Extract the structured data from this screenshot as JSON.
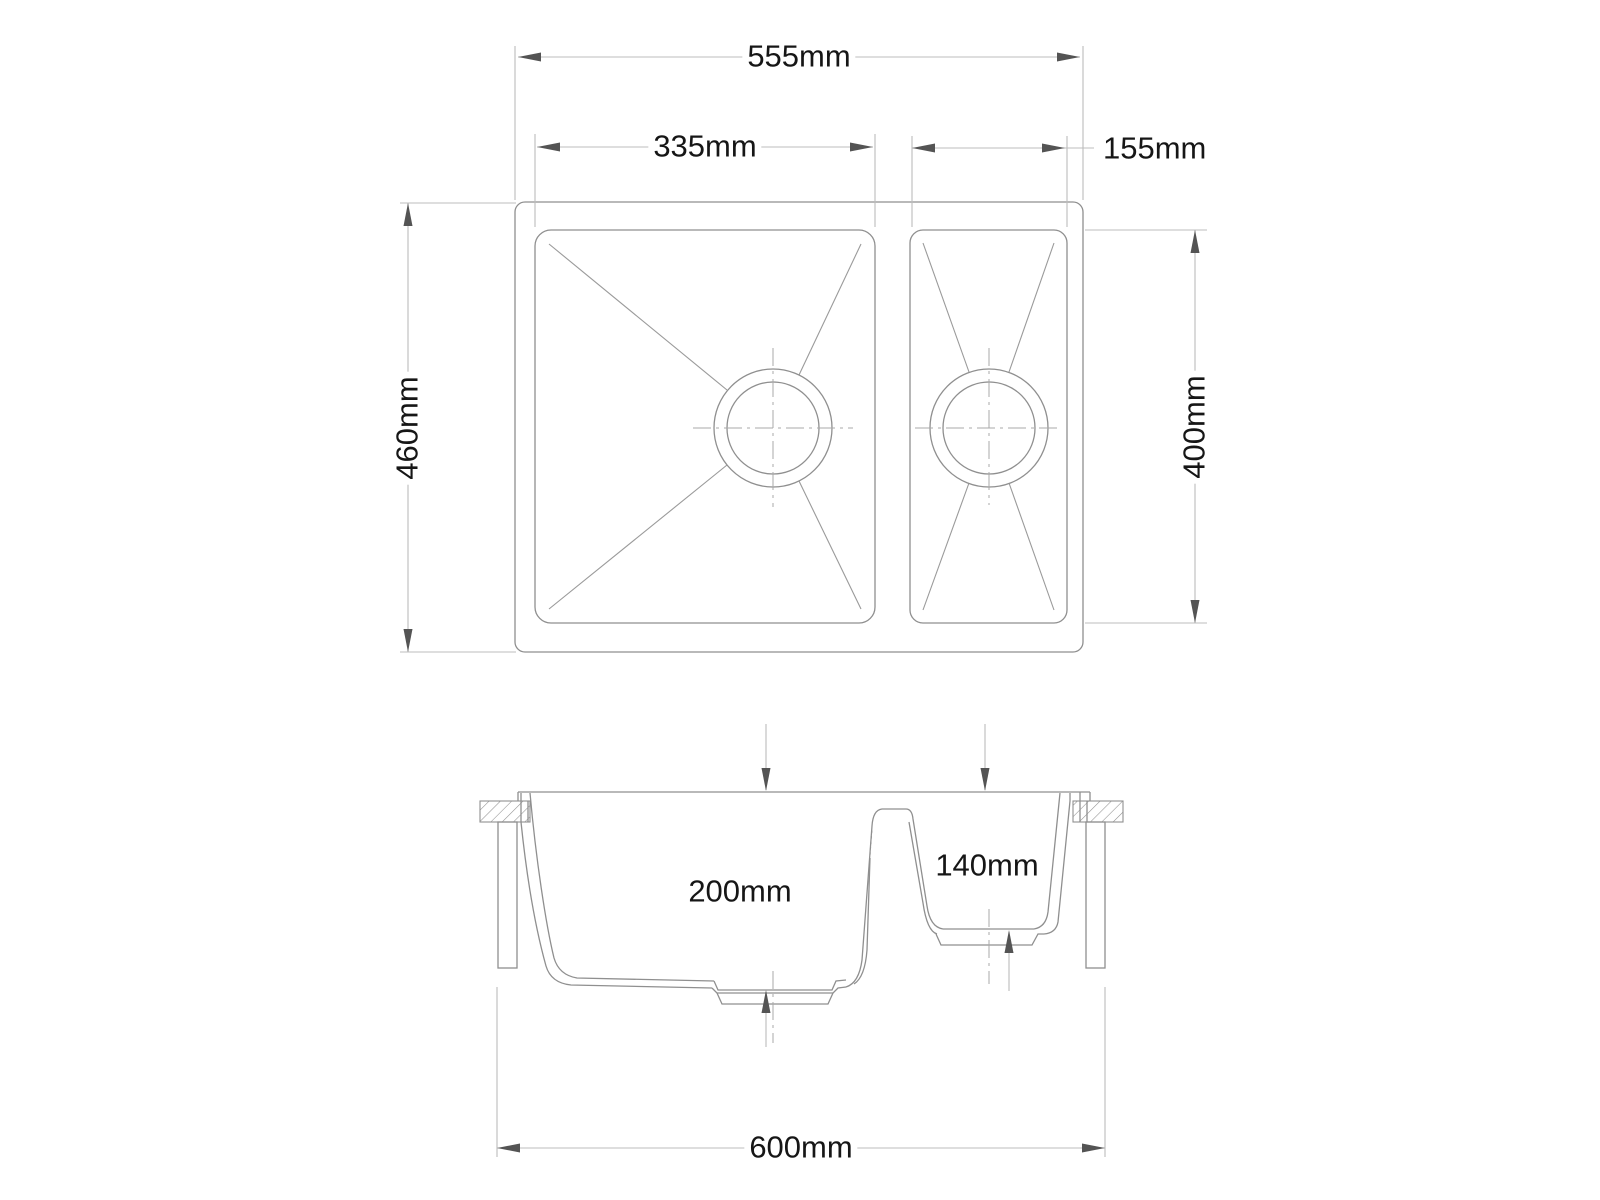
{
  "drawing": {
    "type": "technical-drawing",
    "subject": "one-and-a-half bowl undermount kitchen sink, plan and section views",
    "dims": {
      "overall_width": "555mm",
      "main_bowl_width": "335mm",
      "small_bowl_width": "155mm",
      "overall_depth": "460mm",
      "bowl_front_to_back": "400mm",
      "main_bowl_depth": "200mm",
      "small_bowl_depth": "140mm",
      "cabinet_width": "600mm"
    },
    "colors": {
      "background": "#ffffff",
      "outline": "#8f8f8f",
      "dimension_line": "#bcbcbc",
      "centerline": "#a9a9a9",
      "arrow": "#545454",
      "text": "#161616"
    }
  }
}
